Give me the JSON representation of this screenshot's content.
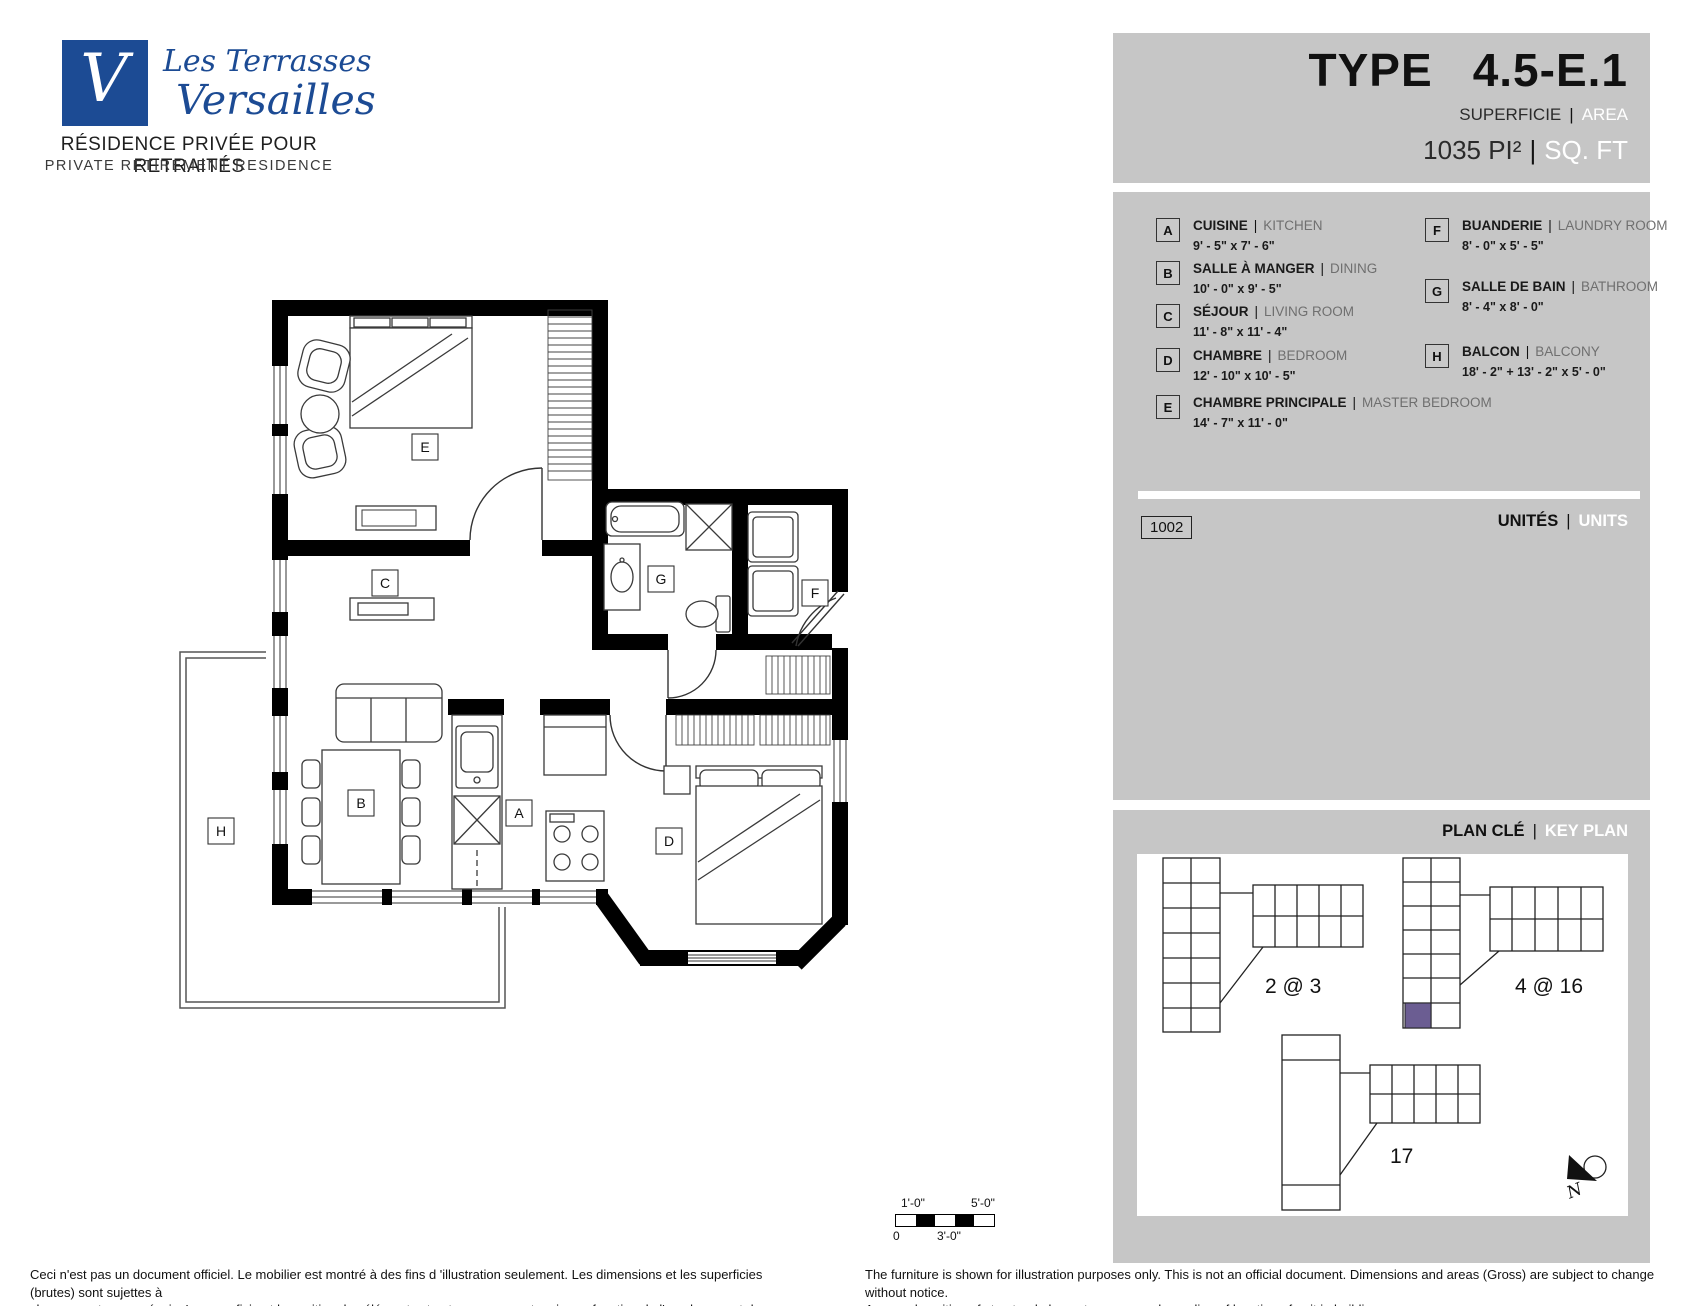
{
  "logo": {
    "mark": "V",
    "name_line1": "Les Terrasses",
    "name_line2": "Versailles",
    "tagline_fr": "RÉSIDENCE PRIVÉE POUR RETRAITÉS",
    "tagline_en": "PRIVATE RETIREMENT RESIDENCE"
  },
  "header": {
    "type_label": "TYPE",
    "type_value": "4.5-E.1",
    "area_label_fr": "SUPERFICIE",
    "area_label_en": "AREA",
    "area_value_fr": "1035 PI²",
    "area_value_en": "SQ. FT"
  },
  "legend": {
    "items": [
      {
        "letter": "A",
        "fr": "CUISINE",
        "en": "KITCHEN",
        "dims": "9' - 5\" x 7' - 6\""
      },
      {
        "letter": "B",
        "fr": "SALLE À MANGER",
        "en": "DINING",
        "dims": "10' - 0\" x 9' - 5\""
      },
      {
        "letter": "C",
        "fr": "SÉJOUR",
        "en": "LIVING ROOM",
        "dims": "11' - 8\" x 11' - 4\""
      },
      {
        "letter": "D",
        "fr": "CHAMBRE",
        "en": "BEDROOM",
        "dims": "12' - 10\" x 10' - 5\""
      },
      {
        "letter": "E",
        "fr": "CHAMBRE PRINCIPALE",
        "en": "MASTER BEDROOM",
        "dims": "14' - 7\" x 11' - 0\""
      },
      {
        "letter": "F",
        "fr": "BUANDERIE",
        "en": "LAUNDRY ROOM",
        "dims": "8' - 0\" x 5' - 5\""
      },
      {
        "letter": "G",
        "fr": "SALLE DE BAIN",
        "en": "BATHROOM",
        "dims": "8' - 4\" x 8' - 0\""
      },
      {
        "letter": "H",
        "fr": "BALCON",
        "en": "BALCONY",
        "dims": "18' - 2\" + 13' - 2\" x 5' - 0\""
      }
    ]
  },
  "units": {
    "label_fr": "UNITÉS",
    "label_en": "UNITS",
    "unit_numbers": [
      "1002"
    ]
  },
  "key_plan": {
    "title_fr": "PLAN CLÉ",
    "title_en": "KEY PLAN",
    "building_labels": [
      "2 @ 3",
      "4 @ 16",
      "17"
    ],
    "highlight_color": "#6b5d92",
    "north_label": "N"
  },
  "floor_plan": {
    "labels": {
      "A": "A",
      "B": "B",
      "C": "C",
      "D": "D",
      "E": "E",
      "F": "F",
      "G": "G",
      "H": "H"
    }
  },
  "scale_bar": {
    "top_labels": [
      "1'-0\"",
      "5'-0\""
    ],
    "bottom_labels": [
      "0",
      "3'-0\""
    ]
  },
  "footer": {
    "fr_line1": "Ceci n'est pas un document officiel.  Le mobilier est montré à des fins d 'illustration seulement.  Les dimensions et les superficies (brutes) sont sujettes à",
    "fr_line2": "changement sans préavis. La superficie et la position des éléments structuraux peuvent varier en fonction de l'emplacement de l'unité dans le bâtiment.",
    "en_line1": "The furniture is shown for illustration purposes only.  This is not an official document.  Dimensions and areas (Gross) are subject to change without notice.",
    "en_line2": "Area and position of structural elements may vary depending of location of unit in building."
  },
  "colors": {
    "panel_gray": "#c6c6c6",
    "logo_blue": "#1c4b94",
    "wall_black": "#000000",
    "highlight_purple": "#6b5d92"
  }
}
